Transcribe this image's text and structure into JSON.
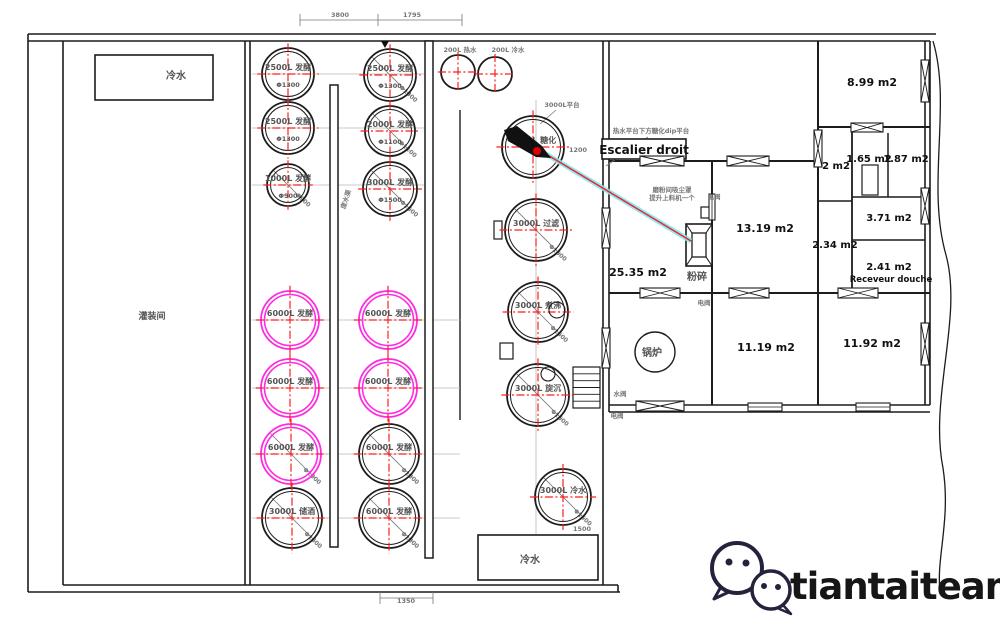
{
  "canvas": {
    "w": 1000,
    "h": 621
  },
  "colors": {
    "wall": "#1c1c1c",
    "gray": "#777777",
    "light": "#b8b8b8",
    "red": "#ff1f1f",
    "magenta": "#ff2be0",
    "cyan": "#7ceaf5",
    "navy": "#23233d",
    "label": "#555555",
    "black": "#111111"
  },
  "branding": {
    "name": "tiantaiteam"
  },
  "plan": {
    "lines": [
      [
        28,
        34,
        936,
        34
      ],
      [
        28,
        41,
        930,
        41
      ],
      [
        28,
        34,
        28,
        592
      ],
      [
        63,
        41,
        63,
        585
      ],
      [
        28,
        592,
        620,
        592
      ],
      [
        63,
        585,
        618,
        585
      ],
      [
        618,
        585,
        618,
        592
      ],
      [
        245,
        41,
        245,
        585
      ],
      [
        250,
        41,
        250,
        585
      ],
      [
        603,
        41,
        603,
        585
      ],
      [
        609,
        41,
        609,
        412
      ],
      [
        609,
        405,
        930,
        405
      ],
      [
        609,
        412,
        930,
        412
      ],
      [
        925,
        41,
        925,
        405
      ],
      [
        930,
        41,
        930,
        405
      ],
      [
        609,
        161,
        818,
        161,
        2
      ],
      [
        818,
        127,
        930,
        127,
        2
      ],
      [
        609,
        293,
        930,
        293,
        2
      ],
      [
        712,
        161,
        712,
        405,
        2
      ],
      [
        818,
        41,
        818,
        293,
        2
      ],
      [
        818,
        293,
        818,
        405,
        2
      ],
      [
        852,
        127,
        852,
        293,
        1.8
      ],
      [
        852,
        197,
        925,
        197,
        1.5
      ],
      [
        888,
        133,
        888,
        197,
        1.5
      ],
      [
        852,
        240,
        925,
        240,
        1.5
      ],
      [
        818,
        201,
        852,
        201,
        1.5
      ],
      [
        460,
        110,
        460,
        420,
        1.4
      ],
      [
        300,
        20,
        462,
        20,
        0.8,
        "gray"
      ],
      [
        300,
        14,
        300,
        26,
        0.8,
        "gray"
      ],
      [
        378,
        14,
        378,
        26,
        0.8,
        "gray"
      ],
      [
        462,
        14,
        462,
        26,
        0.8,
        "gray"
      ],
      [
        380,
        598,
        433,
        598,
        0.8,
        "gray"
      ],
      [
        380,
        592,
        380,
        604,
        0.8,
        "gray"
      ],
      [
        433,
        592,
        433,
        604,
        0.8,
        "gray"
      ],
      [
        252,
        74,
        428,
        74,
        0.8,
        "light"
      ],
      [
        252,
        128,
        428,
        128,
        0.8,
        "light"
      ],
      [
        252,
        185,
        428,
        185,
        0.8,
        "light"
      ],
      [
        252,
        320,
        460,
        320,
        0.8,
        "light"
      ],
      [
        252,
        388,
        460,
        388,
        0.8,
        "light"
      ],
      [
        252,
        454,
        460,
        454,
        0.8,
        "light"
      ],
      [
        252,
        518,
        460,
        518,
        0.8,
        "light"
      ],
      [
        536,
        100,
        536,
        545,
        0.8,
        "light"
      ],
      [
        556,
        110,
        540,
        124,
        0.8,
        "gray"
      ],
      [
        648,
        137,
        606,
        166,
        0.8,
        "gray"
      ]
    ],
    "rects": [
      [
        95,
        55,
        118,
        45,
        1.6
      ],
      [
        478,
        535,
        120,
        45,
        1.6
      ],
      [
        330,
        85,
        8,
        462,
        1.5
      ],
      [
        425,
        41,
        8,
        517,
        1.5
      ],
      [
        602,
        139,
        84,
        20,
        1.6
      ],
      [
        862,
        165,
        16,
        30,
        1.2
      ],
      [
        494,
        221,
        8,
        18,
        1.2
      ],
      [
        500,
        343,
        13,
        16,
        1.2
      ],
      [
        701,
        207,
        12,
        11,
        1.2
      ]
    ],
    "xboxes": [
      [
        640,
        156,
        44,
        10
      ],
      [
        727,
        156,
        42,
        10
      ],
      [
        640,
        288,
        40,
        10
      ],
      [
        729,
        288,
        40,
        10
      ],
      [
        838,
        288,
        40,
        10
      ],
      [
        636,
        401,
        48,
        10
      ],
      [
        814,
        130,
        8,
        37
      ],
      [
        921,
        60,
        8,
        42
      ],
      [
        921,
        188,
        8,
        36
      ],
      [
        921,
        323,
        8,
        42
      ],
      [
        602,
        208,
        8,
        40
      ],
      [
        602,
        328,
        8,
        40
      ],
      [
        851,
        123,
        32,
        9
      ]
    ],
    "winboxes": [
      [
        748,
        403,
        34,
        8
      ],
      [
        856,
        403,
        34,
        8
      ],
      [
        709,
        194,
        6,
        26
      ]
    ],
    "tanks": [
      {
        "cx": 288,
        "cy": 74,
        "r": 26,
        "label": "2500L 发酵",
        "sub": "Φ1300",
        "c": "k"
      },
      {
        "cx": 288,
        "cy": 128,
        "r": 26,
        "label": "2500L 发酵",
        "sub": "Φ1300",
        "c": "k"
      },
      {
        "cx": 288,
        "cy": 185,
        "r": 21,
        "label": "1000L 发酵",
        "sub": "Φ900",
        "c": "k",
        "diag": "Φ900"
      },
      {
        "cx": 290,
        "cy": 320,
        "r": 29,
        "label": "6000L 发酵",
        "c": "m"
      },
      {
        "cx": 290,
        "cy": 388,
        "r": 29,
        "label": "6000L 发酵",
        "c": "m"
      },
      {
        "cx": 291,
        "cy": 454,
        "r": 30,
        "label": "6000L 发酵",
        "c": "m",
        "diag": "Φ1800"
      },
      {
        "cx": 292,
        "cy": 518,
        "r": 30,
        "label": "3000L 储酒",
        "c": "k",
        "diag": "Φ1600"
      },
      {
        "cx": 390,
        "cy": 75,
        "r": 26,
        "label": "2500L 发酵",
        "sub": "Φ1300",
        "c": "k",
        "diag": "Φ1300"
      },
      {
        "cx": 390,
        "cy": 131,
        "r": 25,
        "label": "2000L 发酵",
        "sub": "Φ1100",
        "c": "k",
        "diag": "Φ1100"
      },
      {
        "cx": 390,
        "cy": 189,
        "r": 27,
        "label": "3000L 发酵",
        "sub": "Φ1500",
        "c": "k",
        "diag": "Φ1500"
      },
      {
        "cx": 388,
        "cy": 320,
        "r": 29,
        "label": "6000L 发酵",
        "c": "m"
      },
      {
        "cx": 388,
        "cy": 388,
        "r": 29,
        "label": "6000L 发酵",
        "c": "m"
      },
      {
        "cx": 389,
        "cy": 454,
        "r": 30,
        "label": "6000L 发酵",
        "c": "k",
        "diag": "Φ1800"
      },
      {
        "cx": 389,
        "cy": 518,
        "r": 30,
        "label": "6000L 发酵",
        "c": "k",
        "diag": "Φ1800"
      },
      {
        "cx": 533,
        "cy": 147,
        "r": 31,
        "label": "3000L 糖化",
        "c": "k"
      },
      {
        "cx": 536,
        "cy": 230,
        "r": 31,
        "label": "3000L 过滤",
        "c": "k",
        "diag": "Φ1500"
      },
      {
        "cx": 538,
        "cy": 312,
        "r": 30,
        "label": "3000L 煮沸",
        "c": "k",
        "diag": "Φ1500"
      },
      {
        "cx": 538,
        "cy": 395,
        "r": 31,
        "label": "3000L 旋沉",
        "c": "k",
        "diag": "Φ1500"
      },
      {
        "cx": 563,
        "cy": 497,
        "r": 28,
        "label": "3000L 冷水",
        "c": "k",
        "diag": "Φ1500"
      },
      {
        "cx": 458,
        "cy": 72,
        "r": 17,
        "label": "",
        "c": "k"
      },
      {
        "cx": 495,
        "cy": 74,
        "r": 17,
        "label": "",
        "c": "k"
      }
    ],
    "small_circles": [
      [
        557,
        310,
        8
      ],
      [
        548,
        374,
        7
      ]
    ],
    "room_labels": [
      [
        "8.99 m2",
        872,
        86,
        11
      ],
      [
        "2 m2",
        836,
        169,
        10
      ],
      [
        "1.65 m2",
        869,
        162,
        10
      ],
      [
        "1.87 m2",
        906,
        162,
        10
      ],
      [
        "3.71 m2",
        889,
        221,
        10
      ],
      [
        "2.34 m2",
        835,
        248,
        10
      ],
      [
        "2.41 m2",
        889,
        270,
        10
      ],
      [
        "Receveur douche",
        891,
        282,
        8.5
      ],
      [
        "13.19 m2",
        765,
        232,
        11
      ],
      [
        "25.35 m2",
        638,
        276,
        11
      ],
      [
        "11.19 m2",
        766,
        351,
        11
      ],
      [
        "11.92 m2",
        872,
        347,
        11
      ],
      [
        "Escalier droit",
        644,
        154,
        12
      ]
    ],
    "cn_labels": [
      [
        "粉碎",
        697,
        280,
        10
      ],
      [
        "锅炉",
        652,
        356,
        10
      ],
      [
        "冷水",
        176,
        79,
        10
      ],
      [
        "冷水",
        530,
        563,
        10
      ],
      [
        "灌装间",
        152,
        319,
        9
      ]
    ],
    "tiny_texts": [
      [
        "200L 热水",
        460,
        52,
        0
      ],
      [
        "200L 冷水",
        508,
        52,
        0
      ],
      [
        "3000L平台",
        562,
        107,
        0
      ],
      [
        "热水平台下方糖化dip平台",
        651,
        133,
        0
      ],
      [
        "磨粉间吸尘罩",
        672,
        192,
        0
      ],
      [
        "提升上料机一个",
        672,
        200,
        0
      ],
      [
        "电阀",
        714,
        199,
        0
      ],
      [
        "电阀",
        704,
        305,
        0
      ],
      [
        "水阀",
        620,
        396,
        0
      ],
      [
        "电阀",
        617,
        418,
        0
      ],
      [
        "废水渠",
        348,
        200,
        -72
      ]
    ],
    "dims": [
      [
        "3800",
        340,
        17
      ],
      [
        "1795",
        412,
        17
      ],
      [
        "1350",
        406,
        603
      ],
      [
        "1200",
        578,
        152
      ],
      [
        "1500",
        582,
        531
      ]
    ],
    "laser": {
      "x1": 546,
      "y1": 154,
      "x2": 691,
      "y2": 241
    },
    "arrow_points": "504,130 517,126 542,146 551,158 536,157 508,141",
    "red_dot": [
      537,
      151,
      4
    ],
    "north_mark": "381,41 389,41 385,48",
    "stairs": {
      "x": 573,
      "y": 367,
      "w": 27,
      "h": 41,
      "steps": 5
    },
    "boiler": {
      "cx": 655,
      "cy": 352,
      "r": 20
    },
    "mill": {
      "outer": [
        686,
        224,
        26,
        42
      ],
      "inner": [
        692,
        233,
        14,
        24
      ],
      "joins": [
        [
          686,
          224,
          692,
          233
        ],
        [
          712,
          224,
          706,
          233
        ],
        [
          686,
          266,
          692,
          257
        ],
        [
          712,
          266,
          706,
          257
        ]
      ]
    },
    "break_path": "M933,41 C952,105 926,185 946,255 C963,318 929,398 943,468 C951,520 936,558 940,592",
    "logo": {
      "big": {
        "cx": 737,
        "cy": 568,
        "r": 25,
        "dots": [
          [
            729,
            562
          ],
          [
            746,
            563
          ]
        ],
        "tail": "722,585 714,599 733,590"
      },
      "small": {
        "cx": 771,
        "cy": 590,
        "r": 19,
        "dots": [
          [
            764,
            586
          ],
          [
            778,
            587
          ]
        ],
        "tail": "783,605 791,614 775,607"
      }
    }
  }
}
